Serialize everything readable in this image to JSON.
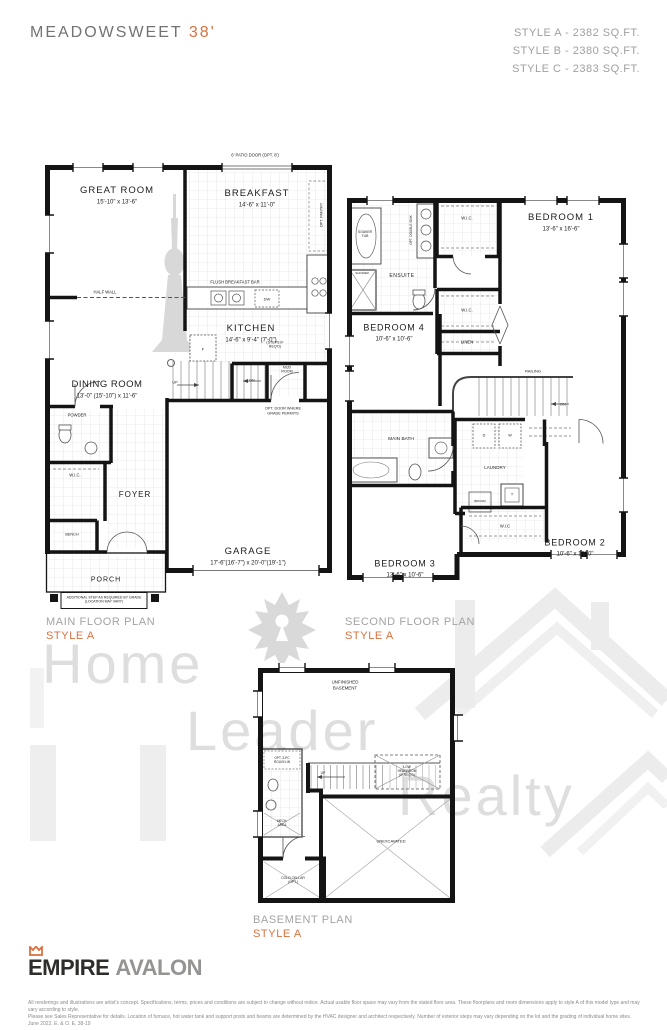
{
  "accent": "#d9713f",
  "header": {
    "title": "MEADOWSWEET",
    "lot": "38'",
    "styles": [
      "STYLE A - 2382 SQ.FT.",
      "STYLE B - 2380 SQ.FT.",
      "STYLE C - 2383 SQ.FT."
    ]
  },
  "watermark": {
    "words": [
      "Home",
      "Leader",
      "Realty"
    ]
  },
  "plans": {
    "main": {
      "caption": "MAIN FLOOR PLAN",
      "style": "STYLE A",
      "labels": [
        {
          "t": "GREAT ROOM",
          "x": 72,
          "y": 28,
          "s": 9.5,
          "ls": 1
        },
        {
          "t": "15'-10\" x 13'-6\"",
          "x": 72,
          "y": 40,
          "s": 6
        },
        {
          "t": "BREAKFAST",
          "x": 212,
          "y": 31,
          "s": 9.5,
          "ls": 1
        },
        {
          "t": "14'-6\" x 11'-0\"",
          "x": 212,
          "y": 43,
          "s": 6
        },
        {
          "t": "6' PATIO DOOR (OPT. 8')",
          "x": 210,
          "y": -8,
          "s": 4.2
        },
        {
          "t": "OPT. PANTRY",
          "x": 277,
          "y": 52,
          "s": 3.8,
          "r": -90
        },
        {
          "t": "HALF WALL",
          "x": 60,
          "y": 129,
          "s": 4.2
        },
        {
          "t": "FLUSH BREAKFAST BAR",
          "x": 190,
          "y": 119,
          "s": 4.2
        },
        {
          "t": "DW",
          "x": 222,
          "y": 136,
          "s": 4
        },
        {
          "t": "KITCHEN",
          "x": 206,
          "y": 166,
          "s": 9.5,
          "ls": 1
        },
        {
          "t": "14'-6\" x 9'-4\" (7'-0\")",
          "x": 206,
          "y": 178,
          "s": 6
        },
        {
          "t": "DINING ROOM",
          "x": 62,
          "y": 222,
          "s": 9.5,
          "ls": 0.5
        },
        {
          "t": "13'-0\" (15'-10\") x 11'-6\"",
          "x": 62,
          "y": 234,
          "s": 6
        },
        {
          "t": "POWDER",
          "x": 32,
          "y": 252,
          "s": 4.2
        },
        {
          "t": "W.I.C.",
          "x": 30,
          "y": 312,
          "s": 4.2
        },
        {
          "t": "FOYER",
          "x": 90,
          "y": 332,
          "s": 8,
          "ls": 1
        },
        {
          "t": "BENCH",
          "x": 27,
          "y": 372,
          "s": 3.8
        },
        {
          "t": "PORCH",
          "x": 61,
          "y": 418,
          "s": 7,
          "ls": 1
        },
        {
          "t": "ADDITIONAL STEP AS REQUIRED BY GRADE\n(LOCATION MAY VARY)",
          "x": 59,
          "y": 437,
          "s": 3.5
        },
        {
          "t": "GARAGE",
          "x": 203,
          "y": 389,
          "s": 9.5,
          "ls": 1
        },
        {
          "t": "17'-6\"(16'-7\") x 20'-0\"(19'-1\")",
          "x": 203,
          "y": 401,
          "s": 6
        },
        {
          "t": "UP",
          "x": 130,
          "y": 220,
          "s": 3.8
        },
        {
          "t": "DN",
          "x": 207,
          "y": 218,
          "s": 3.8
        },
        {
          "t": "(STEPS IF\nREQ'D)",
          "x": 230,
          "y": 182,
          "s": 3.6
        },
        {
          "t": "MUD\nROOM",
          "x": 242,
          "y": 207,
          "s": 3.6
        },
        {
          "t": "OPT. DOOR WHERE\nGRADE PERMITS",
          "x": 238,
          "y": 248,
          "s": 3.8
        },
        {
          "t": "F",
          "x": 158,
          "y": 186,
          "s": 4
        }
      ]
    },
    "second": {
      "caption": "SECOND FLOOR PLAN",
      "style": "STYLE A",
      "labels": [
        {
          "t": "BEDROOM 1",
          "x": 216,
          "y": 22,
          "s": 9.5,
          "ls": 1
        },
        {
          "t": "13'-6\" x 16'-6\"",
          "x": 216,
          "y": 34,
          "s": 6
        },
        {
          "t": "W.I.C.",
          "x": 122,
          "y": 22,
          "s": 4.2
        },
        {
          "t": "SOAKER\nTUB",
          "x": 20,
          "y": 38,
          "s": 3.4
        },
        {
          "t": "SHOWER",
          "x": 17,
          "y": 78,
          "s": 3
        },
        {
          "t": "OPT. DOUBLE SINK",
          "x": 66,
          "y": 34,
          "s": 3.2,
          "r": -90
        },
        {
          "t": "ENSUITE",
          "x": 57,
          "y": 80,
          "s": 5,
          "ls": 0.5
        },
        {
          "t": "BEDROOM 4",
          "x": 49,
          "y": 132,
          "s": 9,
          "ls": 0.8
        },
        {
          "t": "10'-6\" x 10'-6\"",
          "x": 49,
          "y": 144,
          "s": 6
        },
        {
          "t": "W.I.C.",
          "x": 122,
          "y": 114,
          "s": 4.2
        },
        {
          "t": "LINEN",
          "x": 122,
          "y": 146,
          "s": 4.2
        },
        {
          "t": "RAILING",
          "x": 188,
          "y": 175,
          "s": 4
        },
        {
          "t": "DN",
          "x": 218,
          "y": 209,
          "s": 3.8
        },
        {
          "t": "MAIN BATH",
          "x": 56,
          "y": 244,
          "s": 4.8
        },
        {
          "t": "D",
          "x": 139,
          "y": 240,
          "s": 3.8
        },
        {
          "t": "W",
          "x": 165,
          "y": 240,
          "s": 3.8
        },
        {
          "t": "LAUNDRY",
          "x": 150,
          "y": 272,
          "s": 4.5
        },
        {
          "t": "BROOM",
          "x": 135,
          "y": 306,
          "s": 3
        },
        {
          "t": "T",
          "x": 167,
          "y": 299,
          "s": 3.8
        },
        {
          "t": "W.I.C",
          "x": 160,
          "y": 330,
          "s": 4.2
        },
        {
          "t": "BEDROOM 2",
          "x": 230,
          "y": 347,
          "s": 9,
          "ls": 0.8
        },
        {
          "t": "10'-6\" x 13'-0\"",
          "x": 230,
          "y": 359,
          "s": 6
        },
        {
          "t": "BEDROOM 3",
          "x": 60,
          "y": 368,
          "s": 9,
          "ls": 0.8
        },
        {
          "t": "12'-6\" x 10'-6\"",
          "x": 60,
          "y": 380,
          "s": 6
        }
      ]
    },
    "basement": {
      "caption": "BASEMENT PLAN",
      "style": "STYLE A",
      "labels": [
        {
          "t": "UNFINISHED\nBASEMENT",
          "x": 92,
          "y": 22,
          "s": 4.4
        },
        {
          "t": "OPT. 3-PC\nROUGH-IN",
          "x": 29,
          "y": 97,
          "s": 3.2
        },
        {
          "t": "MECH.\nAREA",
          "x": 29,
          "y": 160,
          "s": 3.2
        },
        {
          "t": "LOW\nHEADROOM\n(IF REQ'D)",
          "x": 154,
          "y": 108,
          "s": 3.2
        },
        {
          "t": "UNEXCAVATED",
          "x": 138,
          "y": 178,
          "s": 4
        },
        {
          "t": "COLD CELLAR\n(OPT.)",
          "x": 40,
          "y": 217,
          "s": 3.4
        },
        {
          "t": "UP",
          "x": 70,
          "y": 110,
          "s": 3.4
        }
      ]
    }
  },
  "footer": {
    "brand": "EMPIRE",
    "brand2": "AVALON",
    "disclaimer1": "All renderings and illustrations are artist's concept. Specifications, terms, prices and conditions are subject to change without notice. Actual usable floor space may vary from the stated floor area. These floorplans and room dimensions apply to style A of this model type and may vary according to style.",
    "disclaimer2": "Please see Sales Representative for details. Location of furnace, hot water tank and support posts and beams are determined by the HVAC designer and architect respectively. Number of exterior steps may vary depending on the lot and the grading of individual home sites. June 2022. E. & O. E. 38-19"
  }
}
